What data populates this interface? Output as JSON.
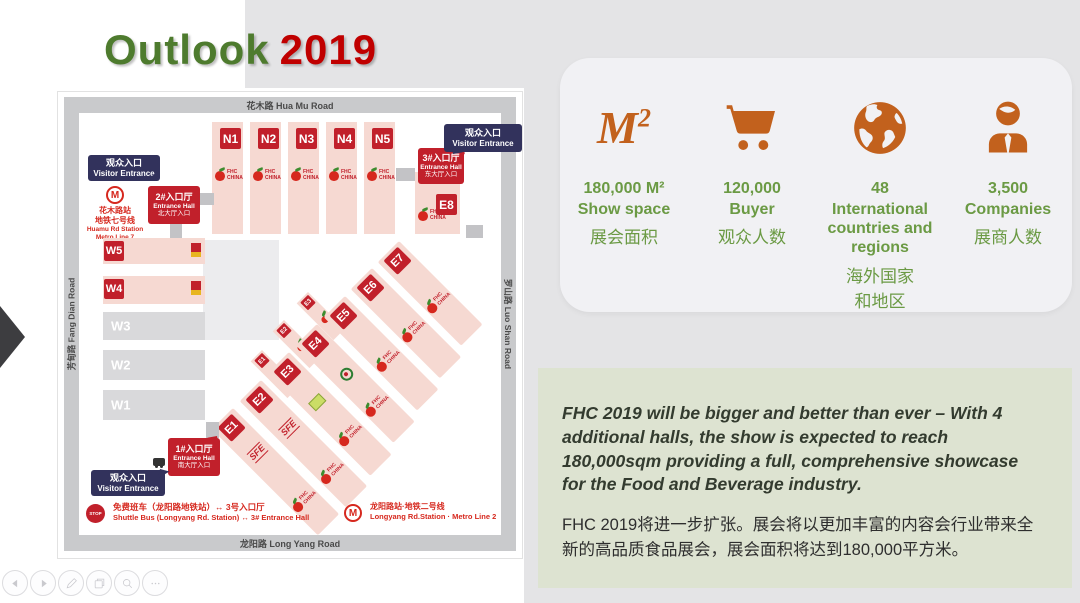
{
  "title": {
    "word1": "Outlook",
    "word2": "2019"
  },
  "map": {
    "roads": {
      "top": "花木路 Hua Mu Road",
      "left": "芳甸路 Fang Dian Road",
      "right": "罗山路 Luo Shan Road",
      "bottom": "龙阳路 Long Yang Road"
    },
    "halls_n": [
      "N1",
      "N2",
      "N3",
      "N4",
      "N5"
    ],
    "halls_w": [
      "W5",
      "W4",
      "W3",
      "W2",
      "W1"
    ],
    "halls_e": [
      "E1",
      "E2",
      "E3",
      "E4",
      "E5",
      "E6",
      "E7"
    ],
    "halls_e_small": [
      "E1",
      "E2",
      "E3"
    ],
    "hall_e8": "E8",
    "visitor_badge": {
      "zh": "观众入口",
      "en": "Visitor Entrance"
    },
    "entrance1": {
      "l1": "1#入口厅",
      "l2": "Entrance Hall",
      "l3": "南大厅入口"
    },
    "entrance2": {
      "l1": "2#入口厅",
      "l2": "Entrance Hall",
      "l3": "北大厅入口"
    },
    "entrance3": {
      "l1": "3#入口厅",
      "l2": "Entrance Hall",
      "l3": "东大厅入口"
    },
    "metro_line7": {
      "l1": "花木路站",
      "l2": "地铁七号线",
      "l3": "Huamu Rd Station",
      "l4": "Metro Line 7"
    },
    "metro_glyph": "M",
    "shuttle": {
      "stop": "STOP",
      "zh": "免费班车（龙阳路地铁站）↔ 3号入口厅",
      "en": "Shuttle Bus (Longyang Rd. Station) ↔ 3# Entrance Hall"
    },
    "metro_line2": {
      "zh": "龙阳路站·地铁二号线",
      "en": "Longyang Rd.Station · Metro Line 2"
    },
    "logo_fhc": "FHC CHINA",
    "logo_sfe": "SFE"
  },
  "stats": [
    {
      "icon": "square-meters",
      "icon_label": "M",
      "icon_sup": "2",
      "value": "180,000 M²",
      "label": "Show space",
      "zh": "展会面积"
    },
    {
      "icon": "shopping-cart",
      "value": "120,000",
      "label": "Buyer",
      "zh": "观众人数"
    },
    {
      "icon": "globe",
      "value": "48",
      "label": "International countries and regions",
      "zh": "海外国家和地区"
    },
    {
      "icon": "businessman",
      "value": "3,500",
      "label": "Companies",
      "zh": "展商人数"
    }
  ],
  "description": {
    "en": "FHC 2019 will be bigger and better than ever – With 4 additional halls, the show is expected to reach 180,000sqm providing a full, comprehensive showcase for the Food and Beverage industry.",
    "zh": "FHC 2019将进一步扩张。展会将以更加丰富的内容会行业带来全新的高品质食品展会，展会面积将达到180,000平方米。"
  },
  "toolbar": {
    "buttons": [
      "previous",
      "next",
      "pen",
      "slides",
      "zoom",
      "more"
    ]
  },
  "colors": {
    "accent_orange": "#C2611D",
    "green_text": "#6B9A44",
    "title_green": "#4E7B2E",
    "title_red": "#C00000",
    "badge_red": "#C1202B",
    "badge_navy": "#32325C",
    "hall_pink": "#F6D9D2",
    "desc_bg": "#DDE3D1",
    "panel_gray": "#E4E4E6"
  }
}
